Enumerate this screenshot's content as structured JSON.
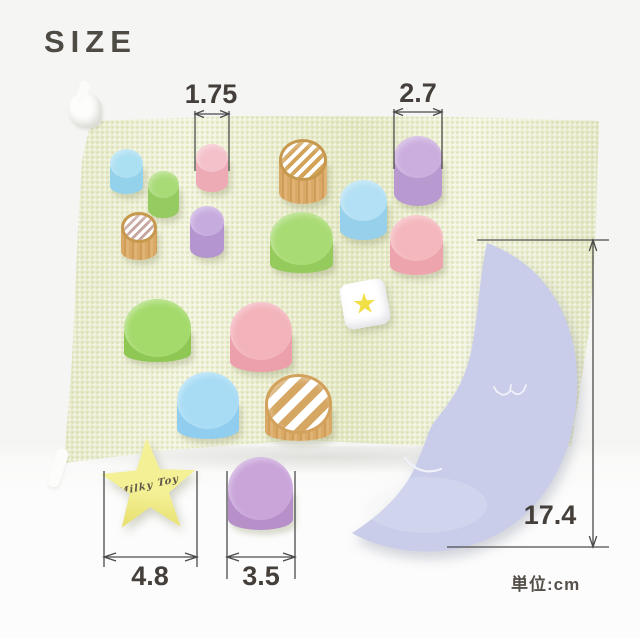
{
  "title": "SIZE",
  "unit_label": "単位:cm",
  "dimensions": {
    "small_cylinder_diameter": "1.75",
    "large_cylinder_diameter": "2.7",
    "moon_height": "17.4",
    "star_width": "4.8",
    "flat_cylinder_diameter": "3.5"
  },
  "colors": {
    "bag": "#eaedc9",
    "moon": "#c9cde9",
    "line": "#4b4b4b",
    "text": "#443f3a",
    "wood": "#d7a763",
    "dice_star": "#f0df45",
    "star_block": "#f2ee8c"
  },
  "scene": {
    "blocks": [
      {
        "name": "cylinder-blue-small",
        "type": "cylinder",
        "x": 110,
        "y": 149,
        "w": 33,
        "h": 45,
        "eh": 29,
        "top": "#abdff2",
        "side": "#93d2ea"
      },
      {
        "name": "cylinder-green-small",
        "type": "cylinder",
        "x": 148,
        "y": 171,
        "w": 31,
        "h": 47,
        "eh": 27,
        "top": "#a8da76",
        "side": "#95cb61"
      },
      {
        "name": "cylinder-pink-small",
        "type": "cylinder",
        "x": 196,
        "y": 144,
        "w": 32,
        "h": 48,
        "eh": 28,
        "top": "#f4c0c9",
        "side": "#edabb6"
      },
      {
        "name": "cylinder-wood-striped-top",
        "type": "striped",
        "x": 279,
        "y": 139,
        "w": 48,
        "h": 65,
        "eh": 42,
        "sw": 4,
        "stripe": "#d2a257",
        "rim": "#c6994f",
        "side": "#d7a763"
      },
      {
        "name": "cylinder-purple-large",
        "type": "cylinder",
        "x": 394,
        "y": 136,
        "w": 48,
        "h": 70,
        "eh": 42,
        "top": "#cbaede",
        "side": "#b99ad0"
      },
      {
        "name": "cylinder-wood-striped-small",
        "type": "striped",
        "x": 121,
        "y": 212,
        "w": 36,
        "h": 48,
        "eh": 31,
        "sw": 3,
        "stripe": "#c7a59f",
        "rim": "#c6994f",
        "side": "#d7a763"
      },
      {
        "name": "cylinder-purple-small",
        "type": "cylinder",
        "x": 190,
        "y": 206,
        "w": 34,
        "h": 52,
        "eh": 30,
        "top": "#c6abdf",
        "side": "#b495cf"
      },
      {
        "name": "cylinder-blue-medium",
        "type": "cylinder",
        "x": 340,
        "y": 180,
        "w": 47,
        "h": 60,
        "eh": 41,
        "top": "#b3e0f4",
        "side": "#97d0ea"
      },
      {
        "name": "cylinder-green-medium",
        "type": "cylinder",
        "x": 270,
        "y": 212,
        "w": 63,
        "h": 61,
        "eh": 53,
        "top": "#a9db74",
        "side": "#95ca5d"
      },
      {
        "name": "cylinder-pink-medium",
        "type": "cylinder",
        "x": 390,
        "y": 215,
        "w": 53,
        "h": 60,
        "eh": 46,
        "top": "#f4b7bd",
        "side": "#eda4ad"
      },
      {
        "name": "cylinder-green-large",
        "type": "cylinder",
        "x": 124,
        "y": 299,
        "w": 67,
        "h": 63,
        "eh": 58,
        "top": "#a4da6b",
        "side": "#8fc754"
      },
      {
        "name": "cylinder-pink-large",
        "type": "cylinder",
        "x": 230,
        "y": 302,
        "w": 62,
        "h": 70,
        "eh": 58,
        "top": "#f3b3bb",
        "side": "#eba0ab"
      },
      {
        "name": "dice-star-block",
        "type": "dice",
        "x": 342,
        "y": 281,
        "w": 46,
        "h": 46,
        "star_glyph": "★",
        "star": "#f0df45"
      },
      {
        "name": "cylinder-blue-large",
        "type": "cylinder",
        "x": 177,
        "y": 372,
        "w": 62,
        "h": 67,
        "eh": 57,
        "top": "#a8dcf5",
        "side": "#90cdee"
      },
      {
        "name": "cylinder-wood-striped-large",
        "type": "striped",
        "x": 265,
        "y": 374,
        "w": 67,
        "h": 67,
        "eh": 60,
        "sw": 8,
        "stripe": "#d6a763",
        "rim": "#d2a25c",
        "side": "#d7a763"
      },
      {
        "name": "star-block",
        "type": "star",
        "x": 100,
        "y": 438,
        "w": 98,
        "h": 96,
        "color": "#f2ee8c",
        "signature": "Milky Toy"
      },
      {
        "name": "cylinder-purple-flat",
        "type": "cylinder",
        "x": 228,
        "y": 457,
        "w": 65,
        "h": 73,
        "eh": 63,
        "top": "#c9a5da",
        "side": "#b78fc9"
      }
    ]
  }
}
